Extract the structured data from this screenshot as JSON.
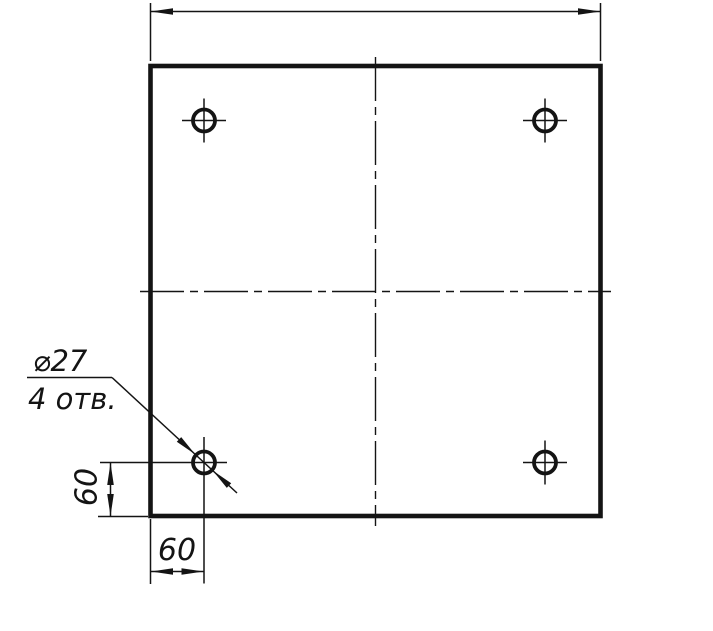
{
  "drawing": {
    "kind": "technical-drawing",
    "callout": {
      "diameter": "⌀27",
      "count": "4 отв."
    },
    "dimensions": {
      "vertical_offset": "60",
      "horizontal_offset": "60"
    },
    "colors": {
      "ink": "#141414",
      "background": "#ffffff"
    },
    "geometry": {
      "plate_px": {
        "x": 150,
        "y": 66,
        "width": 450,
        "height": 450
      },
      "hole_radius_px": 12,
      "hole_centers_px": [
        [
          204,
          120
        ],
        [
          545,
          120
        ],
        [
          204,
          462
        ],
        [
          545,
          462
        ]
      ],
      "hole_diameter_label_mm": 27,
      "hole_count": 4,
      "hole_edge_offset_mm": 60
    }
  }
}
